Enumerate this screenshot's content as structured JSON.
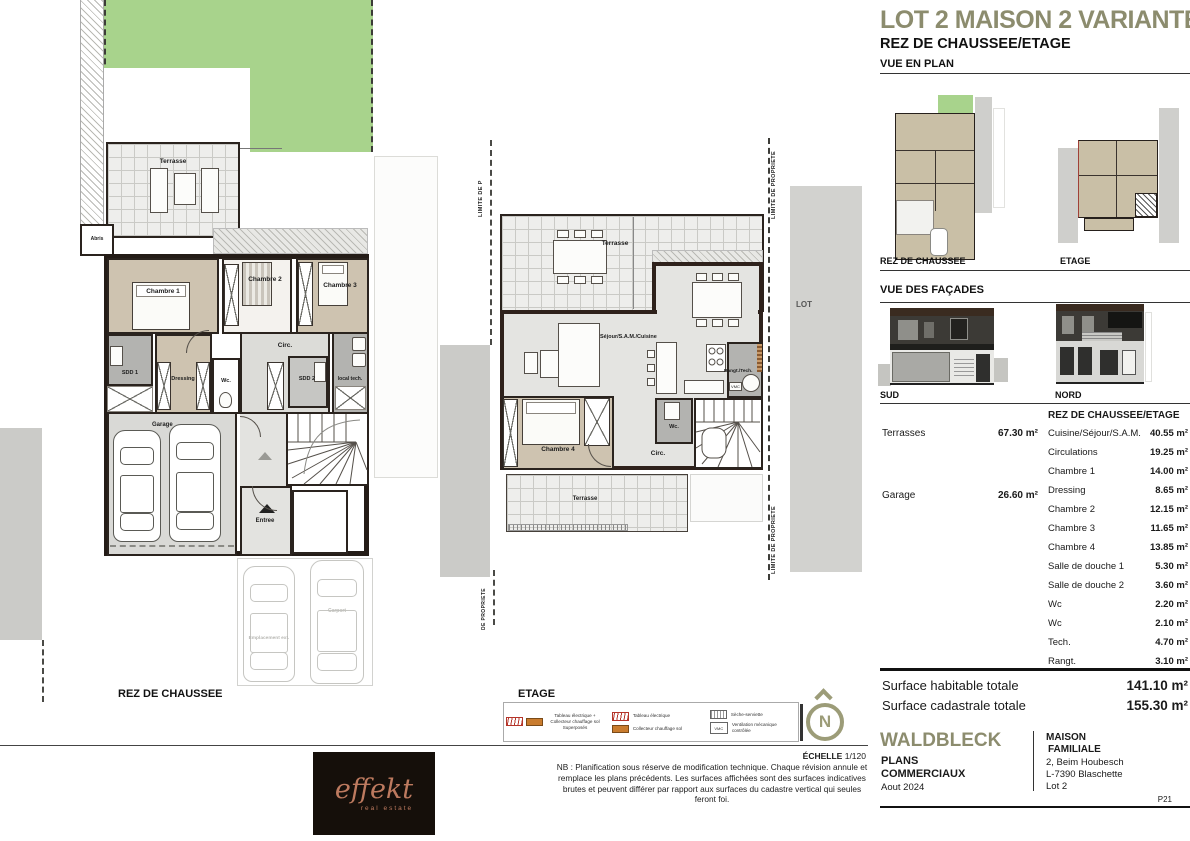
{
  "header": {
    "title": "LOT 2 MAISON 2 VARIANTE 1",
    "subtitle": "REZ DE CHAUSSEE/ETAGE",
    "section_plan": "VUE EN PLAN",
    "section_facades": "VUE DES FAÇADES"
  },
  "thumbnails": {
    "rdc": "REZ DE CHAUSSEE",
    "etage": "ETAGE",
    "sud": "SUD",
    "nord": "NORD"
  },
  "plan_rdc": {
    "title": "REZ DE CHAUSSEE",
    "terrasse": "Terrasse",
    "abris": "Abris",
    "chambre1": "Chambre 1",
    "chambre2": "Chambre 2",
    "chambre3": "Chambre 3",
    "sdd1": "SDD 1",
    "dressing": "Dressing",
    "wc": "Wc.",
    "circ": "Circ.",
    "sdd2": "SDD 2",
    "local_tech": "local tech.",
    "garage": "Garage",
    "entree": "Entree",
    "emplacement": "Emplacement ext.",
    "carport": "Carport"
  },
  "plan_etage": {
    "title": "ETAGE",
    "terrasse_haut": "Terrasse",
    "sejour": "Séjour/S.A.M./Cuisine",
    "rangt": "Rangt./Tech.",
    "vmc": "VMC",
    "chambre4": "Chambre 4",
    "wc": "Wc.",
    "circ": "Circ.",
    "terrasse_bas": "Terrasse"
  },
  "boundaries": {
    "limite_p": "LIMITE DE P",
    "de_propriete": "DE PROPRIETE",
    "limite_full": "LIMITE DE PROPRIETE",
    "lot": "LOT"
  },
  "areas": {
    "outdoor": [
      {
        "label": "Terrasses",
        "value": "67.30 m²"
      },
      {
        "label": "Garage",
        "value": "26.60 m²"
      }
    ],
    "header": "REZ DE CHAUSSEE/ETAGE",
    "rooms": [
      {
        "label": "Cuisine/Séjour/S.A.M.",
        "value": "40.55 m²"
      },
      {
        "label": "Circulations",
        "value": "19.25 m²"
      },
      {
        "label": "Chambre 1",
        "value": "14.00 m²"
      },
      {
        "label": "Dressing",
        "value": "8.65 m²"
      },
      {
        "label": "Chambre 2",
        "value": "12.15 m²"
      },
      {
        "label": "Chambre 3",
        "value": "11.65 m²"
      },
      {
        "label": "Chambre 4",
        "value": "13.85 m²"
      },
      {
        "label": "Salle de douche 1",
        "value": "5.30 m²"
      },
      {
        "label": "Salle de douche 2",
        "value": "3.60 m²"
      },
      {
        "label": "Wc",
        "value": "2.20 m²"
      },
      {
        "label": "Wc",
        "value": "2.10 m²"
      },
      {
        "label": "Tech.",
        "value": "4.70 m²"
      },
      {
        "label": "Rangt.",
        "value": "3.10 m²"
      }
    ]
  },
  "totals": [
    {
      "label": "Surface habitable totale",
      "value": "141.10 m²"
    },
    {
      "label": "Surface cadastrale totale",
      "value": "155.30 m²"
    }
  ],
  "legend": {
    "items": [
      "Tableau électrique + Collecteur chauffage sol Superposés",
      "Tableau électrique",
      "Collecteur chauffage sol",
      "Sèche-serviette",
      "Ventilation mécanique contrôlée"
    ],
    "vmc_text": "VMC",
    "north": "N"
  },
  "scale": {
    "label": "ÉCHELLE",
    "value": "1/120"
  },
  "note": "NB : Planification sous réserve de modification technique. Chaque révision annule et remplace les plans précédents. Les surfaces affichées sont des surfaces indicatives brutes et peuvent différer par rapport aux surfaces du cadastre vertical qui seules feront foi.",
  "footer": {
    "brand": "WALDBLECK",
    "doc1": "PLANS",
    "doc2": "COMMERCIAUX",
    "date": "Aout 2024",
    "client1": "MAISON",
    "client2": "FAMILIALE",
    "addr1": "2, Beim Houbesch",
    "addr2": "L-7390 Blaschette",
    "addr3": "Lot 2",
    "page": "P21"
  },
  "logo": {
    "name": "effekt",
    "tagline": "real estate"
  },
  "colors": {
    "accent": "#8c8c6e",
    "garden": "#a8d38c",
    "beige": "#cec3b0",
    "logo_text": "#bd7a5f"
  }
}
